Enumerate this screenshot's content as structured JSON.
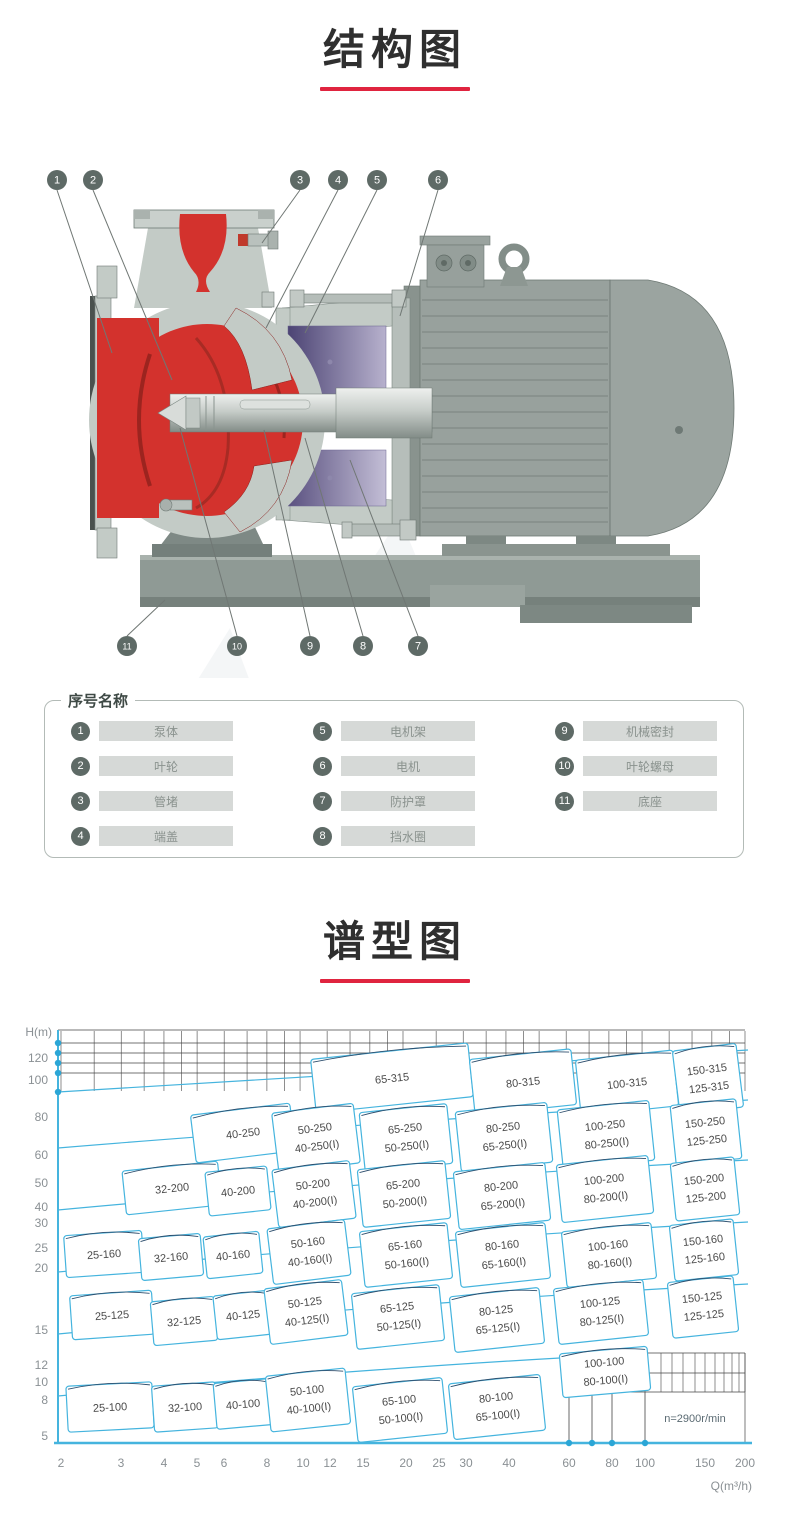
{
  "sections": {
    "structure_title": "结构图",
    "spectrum_title": "谱型图"
  },
  "colors": {
    "accent_underline": "#e0243f",
    "pump_red": "#d3322d",
    "motor_gray": "#98a19d",
    "frame_purple_dark": "#4c4474",
    "frame_purple_light": "#b7b1cd",
    "chart_cyan": "#45b4de",
    "chart_navy": "#2e4f6e",
    "chart_dot": "#2ba6d6"
  },
  "legend": {
    "title": "序号名称",
    "columns": [
      [
        {
          "num": "1",
          "label": "泵体"
        },
        {
          "num": "2",
          "label": "叶轮"
        },
        {
          "num": "3",
          "label": "管堵"
        },
        {
          "num": "4",
          "label": "端盖"
        }
      ],
      [
        {
          "num": "5",
          "label": "电机架"
        },
        {
          "num": "6",
          "label": "电机"
        },
        {
          "num": "7",
          "label": "防护罩"
        },
        {
          "num": "8",
          "label": "挡水圈"
        }
      ],
      [
        {
          "num": "9",
          "label": "机械密封"
        },
        {
          "num": "10",
          "label": "叶轮螺母"
        },
        {
          "num": "11",
          "label": "底座"
        }
      ]
    ]
  },
  "diagram": {
    "callouts": [
      {
        "num": "1",
        "x": 57,
        "y": 32,
        "tx": 112,
        "ty": 205
      },
      {
        "num": "2",
        "x": 93,
        "y": 32,
        "tx": 172,
        "ty": 232
      },
      {
        "num": "3",
        "x": 300,
        "y": 32,
        "tx": 262,
        "ty": 95
      },
      {
        "num": "4",
        "x": 338,
        "y": 32,
        "tx": 266,
        "ty": 180
      },
      {
        "num": "5",
        "x": 377,
        "y": 32,
        "tx": 305,
        "ty": 185
      },
      {
        "num": "6",
        "x": 438,
        "y": 32,
        "tx": 400,
        "ty": 168
      },
      {
        "num": "11",
        "x": 127,
        "y": 498,
        "tx": 165,
        "ty": 452
      },
      {
        "num": "10",
        "x": 237,
        "y": 498,
        "tx": 180,
        "ty": 280
      },
      {
        "num": "9",
        "x": 310,
        "y": 498,
        "tx": 264,
        "ty": 282
      },
      {
        "num": "8",
        "x": 363,
        "y": 498,
        "tx": 305,
        "ty": 290
      },
      {
        "num": "7",
        "x": 418,
        "y": 498,
        "tx": 350,
        "ty": 312
      }
    ]
  },
  "chart_data": {
    "type": "area",
    "subtype": "pump-model-selection-regions",
    "title": "谱型图",
    "xlabel": "Q(m³/h)",
    "ylabel": "H(m)",
    "x_log_scale": true,
    "y_log_scale": true,
    "annotation": "n=2900r/min",
    "x_ticks": [
      {
        "v": "2",
        "px": 61
      },
      {
        "v": "3",
        "px": 121
      },
      {
        "v": "4",
        "px": 164
      },
      {
        "v": "5",
        "px": 197
      },
      {
        "v": "6",
        "px": 224
      },
      {
        "v": "8",
        "px": 267
      },
      {
        "v": "10",
        "px": 303
      },
      {
        "v": "12",
        "px": 330
      },
      {
        "v": "15",
        "px": 363
      },
      {
        "v": "20",
        "px": 406
      },
      {
        "v": "25",
        "px": 439
      },
      {
        "v": "30",
        "px": 466
      },
      {
        "v": "40",
        "px": 509
      },
      {
        "v": "60",
        "px": 569
      },
      {
        "v": "80",
        "px": 612
      },
      {
        "v": "100",
        "px": 645
      },
      {
        "v": "150",
        "px": 705
      },
      {
        "v": "200",
        "px": 745
      }
    ],
    "y_ticks": [
      {
        "v": "120",
        "px": 38
      },
      {
        "v": "100",
        "px": 60
      },
      {
        "v": "80",
        "px": 97
      },
      {
        "v": "60",
        "px": 135
      },
      {
        "v": "50",
        "px": 163
      },
      {
        "v": "40",
        "px": 187
      },
      {
        "v": "30",
        "px": 203
      },
      {
        "v": "25",
        "px": 228
      },
      {
        "v": "20",
        "px": 248
      },
      {
        "v": "15",
        "px": 310
      },
      {
        "v": "12",
        "px": 345
      },
      {
        "v": "10",
        "px": 362
      },
      {
        "v": "8",
        "px": 380
      },
      {
        "v": "5",
        "px": 416
      }
    ],
    "axis_dots_left_y": [
      23,
      33,
      43,
      53,
      72
    ],
    "axis_dots_bottom_x": [
      569,
      592,
      612,
      645
    ],
    "regions": [
      {
        "labels": [
          "65-315"
        ],
        "x": 392,
        "y": 58,
        "w": 158,
        "h": 54,
        "r": -6
      },
      {
        "labels": [
          "80-315"
        ],
        "x": 523,
        "y": 62,
        "w": 102,
        "h": 56,
        "r": -6
      },
      {
        "labels": [
          "100-315"
        ],
        "x": 627,
        "y": 63,
        "w": 98,
        "h": 56,
        "r": -6
      },
      {
        "labels": [
          "150-315",
          "125-315"
        ],
        "x": 708,
        "y": 59,
        "w": 64,
        "h": 64,
        "r": -7
      },
      {
        "labels": [
          "40-250"
        ],
        "x": 243,
        "y": 113,
        "w": 100,
        "h": 48,
        "r": -7
      },
      {
        "labels": [
          "50-250",
          "40-250(I)"
        ],
        "x": 316,
        "y": 118,
        "w": 82,
        "h": 60,
        "r": -7
      },
      {
        "labels": [
          "65-250",
          "50-250(I)"
        ],
        "x": 406,
        "y": 118,
        "w": 88,
        "h": 60,
        "r": -6
      },
      {
        "labels": [
          "80-250",
          "65-250(I)"
        ],
        "x": 504,
        "y": 117,
        "w": 92,
        "h": 60,
        "r": -6
      },
      {
        "labels": [
          "100-250",
          "80-250(I)"
        ],
        "x": 606,
        "y": 115,
        "w": 92,
        "h": 60,
        "r": -6
      },
      {
        "labels": [
          "150-250",
          "125-250"
        ],
        "x": 706,
        "y": 112,
        "w": 66,
        "h": 60,
        "r": -6
      },
      {
        "labels": [
          "32-200"
        ],
        "x": 172,
        "y": 168,
        "w": 96,
        "h": 44,
        "r": -6
      },
      {
        "labels": [
          "40-200"
        ],
        "x": 238,
        "y": 171,
        "w": 62,
        "h": 44,
        "r": -6
      },
      {
        "labels": [
          "50-200",
          "40-200(I)"
        ],
        "x": 314,
        "y": 174,
        "w": 78,
        "h": 58,
        "r": -7
      },
      {
        "labels": [
          "65-200",
          "50-200(I)"
        ],
        "x": 404,
        "y": 174,
        "w": 88,
        "h": 58,
        "r": -6
      },
      {
        "labels": [
          "80-200",
          "65-200(I)"
        ],
        "x": 502,
        "y": 176,
        "w": 92,
        "h": 58,
        "r": -6
      },
      {
        "labels": [
          "100-200",
          "80-200(I)"
        ],
        "x": 605,
        "y": 169,
        "w": 92,
        "h": 58,
        "r": -6
      },
      {
        "labels": [
          "150-200",
          "125-200"
        ],
        "x": 705,
        "y": 169,
        "w": 64,
        "h": 58,
        "r": -6
      },
      {
        "labels": [
          "25-160"
        ],
        "x": 104,
        "y": 234,
        "w": 78,
        "h": 42,
        "r": -4
      },
      {
        "labels": [
          "32-160"
        ],
        "x": 171,
        "y": 237,
        "w": 62,
        "h": 42,
        "r": -5
      },
      {
        "labels": [
          "40-160"
        ],
        "x": 233,
        "y": 235,
        "w": 56,
        "h": 42,
        "r": -6
      },
      {
        "labels": [
          "50-160",
          "40-160(I)"
        ],
        "x": 309,
        "y": 232,
        "w": 78,
        "h": 56,
        "r": -7
      },
      {
        "labels": [
          "65-160",
          "50-160(I)"
        ],
        "x": 406,
        "y": 235,
        "w": 88,
        "h": 56,
        "r": -6
      },
      {
        "labels": [
          "80-160",
          "65-160(I)"
        ],
        "x": 503,
        "y": 235,
        "w": 90,
        "h": 56,
        "r": -6
      },
      {
        "labels": [
          "100-160",
          "80-160(I)"
        ],
        "x": 609,
        "y": 235,
        "w": 90,
        "h": 56,
        "r": -6
      },
      {
        "labels": [
          "150-160",
          "125-160"
        ],
        "x": 704,
        "y": 230,
        "w": 64,
        "h": 56,
        "r": -6
      },
      {
        "labels": [
          "25-125"
        ],
        "x": 112,
        "y": 295,
        "w": 82,
        "h": 44,
        "r": -4
      },
      {
        "labels": [
          "32-125"
        ],
        "x": 184,
        "y": 301,
        "w": 64,
        "h": 44,
        "r": -5
      },
      {
        "labels": [
          "40-125"
        ],
        "x": 243,
        "y": 295,
        "w": 56,
        "h": 44,
        "r": -6
      },
      {
        "labels": [
          "50-125",
          "40-125(I)"
        ],
        "x": 306,
        "y": 292,
        "w": 78,
        "h": 56,
        "r": -7
      },
      {
        "labels": [
          "65-125",
          "50-125(I)"
        ],
        "x": 398,
        "y": 297,
        "w": 88,
        "h": 56,
        "r": -6
      },
      {
        "labels": [
          "80-125",
          "65-125(I)"
        ],
        "x": 497,
        "y": 300,
        "w": 90,
        "h": 56,
        "r": -6
      },
      {
        "labels": [
          "100-125",
          "80-125(I)"
        ],
        "x": 601,
        "y": 292,
        "w": 90,
        "h": 56,
        "r": -6
      },
      {
        "labels": [
          "150-125",
          "125-125"
        ],
        "x": 703,
        "y": 287,
        "w": 66,
        "h": 56,
        "r": -6
      },
      {
        "labels": [
          "25-100"
        ],
        "x": 110,
        "y": 387,
        "w": 86,
        "h": 46,
        "r": -3
      },
      {
        "labels": [
          "32-100"
        ],
        "x": 185,
        "y": 387,
        "w": 64,
        "h": 46,
        "r": -4
      },
      {
        "labels": [
          "40-100"
        ],
        "x": 243,
        "y": 384,
        "w": 56,
        "h": 46,
        "r": -5
      },
      {
        "labels": [
          "50-100",
          "40-100(I)"
        ],
        "x": 308,
        "y": 380,
        "w": 80,
        "h": 56,
        "r": -6
      },
      {
        "labels": [
          "65-100",
          "50-100(I)"
        ],
        "x": 400,
        "y": 390,
        "w": 90,
        "h": 56,
        "r": -6
      },
      {
        "labels": [
          "80-100",
          "65-100(I)"
        ],
        "x": 497,
        "y": 387,
        "w": 92,
        "h": 56,
        "r": -6
      },
      {
        "labels": [
          "100-100",
          "80-100(I)"
        ],
        "x": 605,
        "y": 352,
        "w": 88,
        "h": 44,
        "r": -5
      }
    ]
  }
}
